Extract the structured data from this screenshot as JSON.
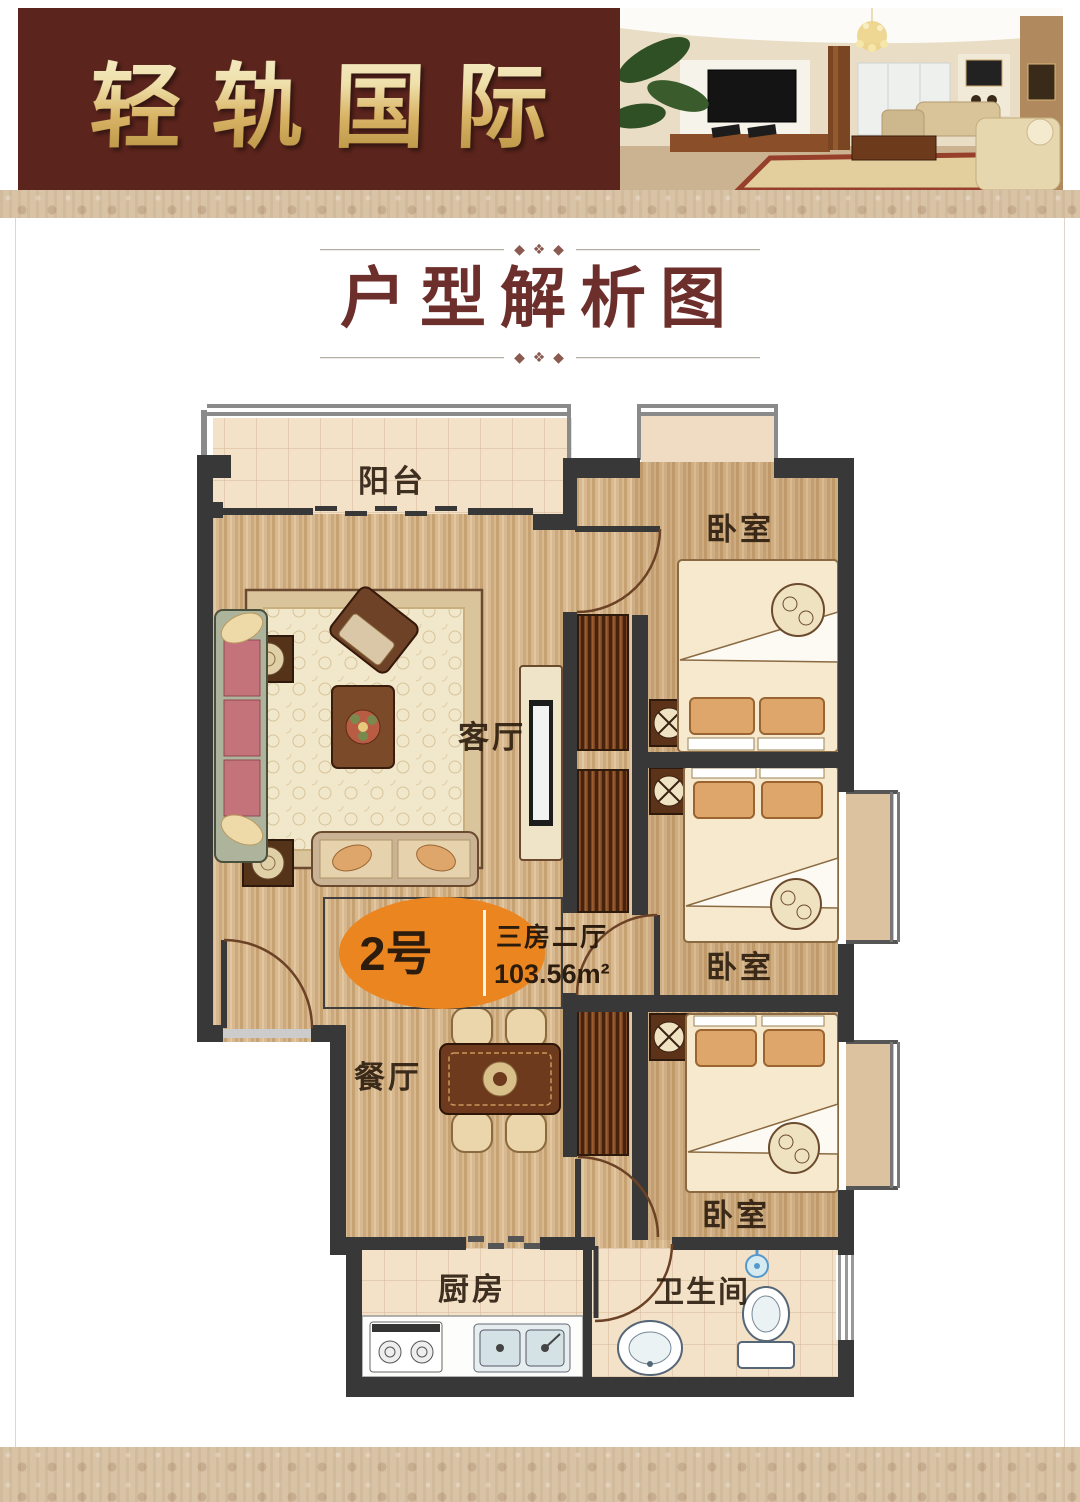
{
  "header": {
    "brand": "轻轨国际"
  },
  "section_title": {
    "text": "户型解析图"
  },
  "floorplan": {
    "badge": {
      "unit": "2号",
      "layout": "三房二厅",
      "area": "103.56m²"
    },
    "labels": {
      "balcony": "阳台",
      "bedroom1": "卧室",
      "bedroom2": "卧室",
      "bedroom3": "卧室",
      "living": "客厅",
      "dining": "餐厅",
      "kitchen": "厨房",
      "bathroom": "卫生间"
    },
    "colors": {
      "wall": "#383838",
      "wood_floor": "#d8b88f",
      "tile_floor": "#f3e1c8",
      "badge_orange": "#eb8520",
      "header_maroon": "#5b241c",
      "title_maroon": "#6d2f2b"
    }
  }
}
